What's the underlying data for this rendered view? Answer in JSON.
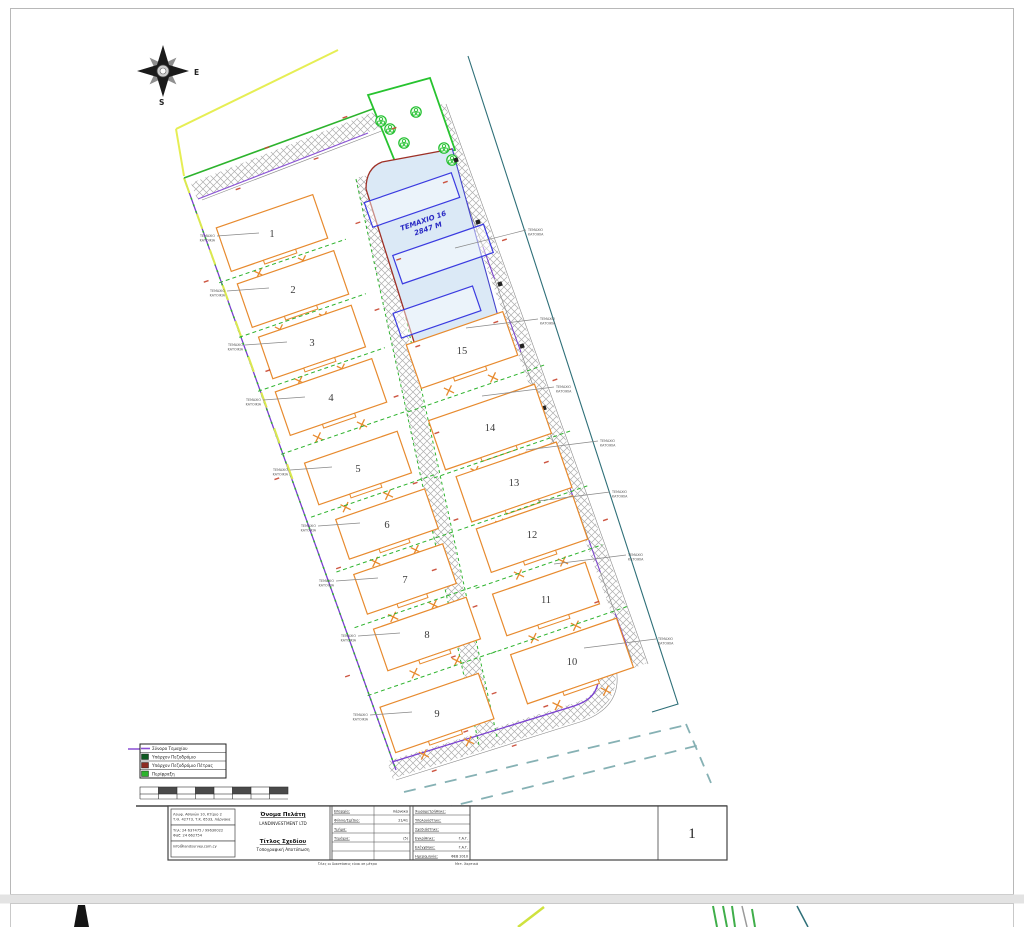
{
  "plan": {
    "compass": {
      "east_label": "E",
      "south_label": "S"
    },
    "parcel16": {
      "name": "ΤΕΜΑΧΙΟ 16",
      "area": "2847 M"
    },
    "plots": [
      "1",
      "2",
      "3",
      "4",
      "5",
      "6",
      "7",
      "8",
      "9",
      "15",
      "14",
      "13",
      "12",
      "11",
      "10"
    ],
    "annotation_left": [
      "ΤΕΜΑΧΙΟ",
      "ΚΑΤΟΙΚΙΑ"
    ],
    "annotation_right": [
      "ΤΕΜΑΧΙΟ",
      "ΚΑΤΟΙΚΙΑ"
    ]
  },
  "legend": {
    "items": [
      {
        "label": "Σύνορο Τεμαχίου",
        "swatch": "#8a4fd3",
        "style": "line"
      },
      {
        "label": "Υπάρχον Πεζοδρόμιο",
        "swatch": "#0e5a20",
        "style": "fill"
      },
      {
        "label": "Υπάρχον Πεζοδρόμιο Πέτρας",
        "swatch": "#8e2b22",
        "style": "fill"
      },
      {
        "label": "Περίφραξη",
        "swatch": "#2db32d",
        "style": "fill"
      }
    ]
  },
  "titleblock": {
    "contact_cells": [
      [
        "Λεωφ. Αθηνών 10, Κτίριο 2",
        "Τ.Θ. 42773, Τ.Κ. 6533, Λάρνακα"
      ],
      [
        "Τηλ: 24 637475 / 99630022",
        "Φαξ: 24 662754"
      ],
      [
        "info@landsurvey.com.cy"
      ]
    ],
    "client_label": "Όνομα Πελάτη",
    "client_name": "LANDINVESTMENT LTD",
    "title_label": "Τίτλος Σχεδίου",
    "title_value": "Τοπογραφική Αποτύπωση",
    "fields_a": [
      [
        "Επαρχία:",
        "Λάρνακα"
      ],
      [
        "Φύλλο/Σχέδιο:",
        "21/41"
      ],
      [
        "Τμήμα:",
        ""
      ],
      [
        "Τεμάχια:",
        "(5)"
      ]
    ],
    "fields_b": [
      [
        "Χωρομετρήθηκε:",
        ""
      ],
      [
        "Υπολογίστηκε:",
        ""
      ],
      [
        "Σχεδιάστηκε:",
        ""
      ],
      [
        "Εγκρίθηκε:",
        "Γ.Α.Γ."
      ],
      [
        "Ελέγχθηκε:",
        "Γ.Α.Γ."
      ],
      [
        "Ημερομηνία:",
        "ΦΕΒ 2010"
      ]
    ],
    "sheet_number": "1",
    "footnote_left": "Όλες οι διαστάσεις είναι σε μέτρα",
    "footnote_right": "Μετ. Χαρτικά"
  }
}
